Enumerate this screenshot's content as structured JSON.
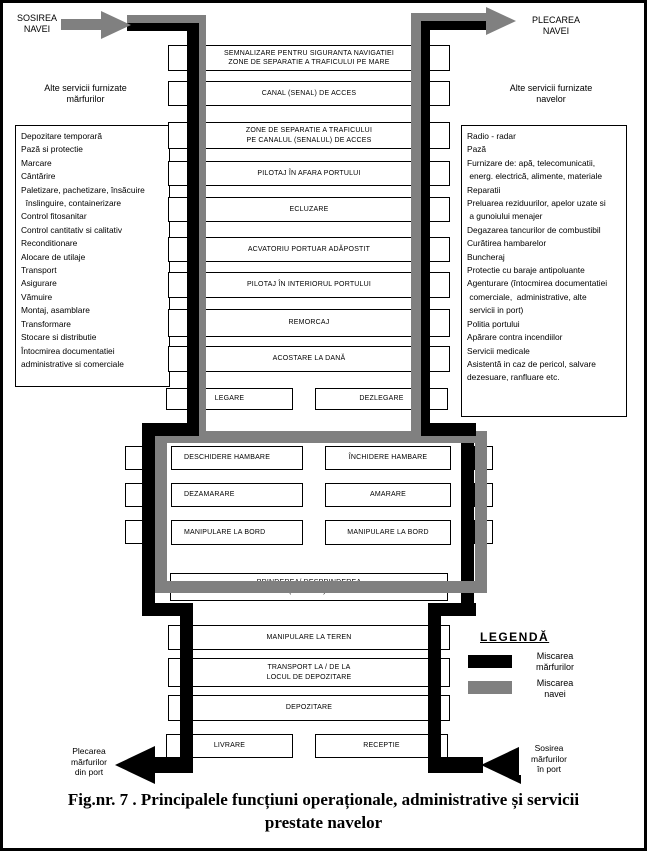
{
  "colors": {
    "cargo_path": "#000000",
    "ship_path": "#808080"
  },
  "top_left": {
    "label": "SOSIREA\nNAVEI"
  },
  "top_right": {
    "label": "PLECAREA\nNAVEI"
  },
  "side_left": {
    "header": "Alte servicii furnizate\nmărfurilor",
    "items": "Depozitare temporară\nPază si protectie\nMarcare\nCântărire\nPaletizare, pachetizare, însăcuire\n  înslinguire, containerizare\nControl fitosanitar\nControl cantitativ si calitativ\nReconditionare\nAlocare de utilaje\nTransport\nAsigurare\nVămuire\nMontaj, asamblare\nTransformare\nStocare si distributie\nÎntocmirea documentatiei\nadministrative si comerciale"
  },
  "side_right": {
    "header": "Alte servicii furnizate\nnavelor",
    "items": "Radio - radar\nPază\nFurnizare de: apă, telecomunicatii,\n energ. electrică, alimente, materiale\nReparatii\nPreluarea reziduurilor, apelor uzate si\n a gunoiului menajer\nDegazarea tancurilor de combustibil\nCurătirea hambarelor\nBuncheraj\nProtectie cu baraje antipoluante\nAgenturare (întocmirea documentatiei\n comerciale,  administrative, alte\n servicii in port)\nPolitia portului\nApărare contra incendiilor\nServicii medicale\nAsistentă in caz de pericol, salvare\ndezesuare, ranfluare etc."
  },
  "flow": {
    "upper": [
      {
        "label": "SEMNALIZARE PENTRU SIGURANTA NAVIGATIEI\nZONE DE SEPARATIE A TRAFICULUI PE MARE"
      },
      {
        "label": "CANAL (SENAL) DE ACCES"
      },
      {
        "label": "ZONE DE SEPARATIE A TRAFICULUI\nPE CANALUL (SENALUL) DE ACCES"
      },
      {
        "label": "PILOTAJ ÎN AFARA PORTULUI"
      },
      {
        "label": "ECLUZARE"
      },
      {
        "label": "ACVATORIU PORTUAR ADĂPOSTIT"
      },
      {
        "label": "PILOTAJ ÎN INTERIORUL PORTULUI"
      },
      {
        "label": "REMORCAJ"
      },
      {
        "label": "ACOSTARE LA DANĂ"
      }
    ],
    "legare": "LEGARE",
    "dezlegare": "DEZLEGARE",
    "middle": [
      {
        "left": "DESCHIDERE HAMBARE",
        "right": "ÎNCHIDERE HAMBARE"
      },
      {
        "left": "DEZAMARARE",
        "right": "AMARARE"
      },
      {
        "left": "MANIPULARE LA BORD",
        "right": "MANIPULARE LA BORD"
      }
    ],
    "prindere": "PRINDEREA/ DESPRINDEREA\nSARCINII (COTADEI) LA TEREN",
    "lower": [
      {
        "label": "MANIPULARE LA TEREN"
      },
      {
        "label": "TRANSPORT LA / DE LA\nLOCUL DE DEPOZITARE"
      },
      {
        "label": "DEPOZITARE"
      }
    ],
    "livrare": "LIVRARE",
    "receptie": "RECEPTIE"
  },
  "bottom_left": {
    "label": "Plecarea\nmărfurilor\ndin port"
  },
  "bottom_right": {
    "label": "Sosirea\nmărfurilor\nîn port"
  },
  "legend": {
    "title": "LEGENDĂ",
    "cargo_label": "Miscarea\nmărfurilor",
    "ship_label": "Miscarea\nnavei"
  },
  "caption": "Fig.nr. 7 . Principalele funcțiuni operaționale, administrative și servicii\nprestate navelor"
}
